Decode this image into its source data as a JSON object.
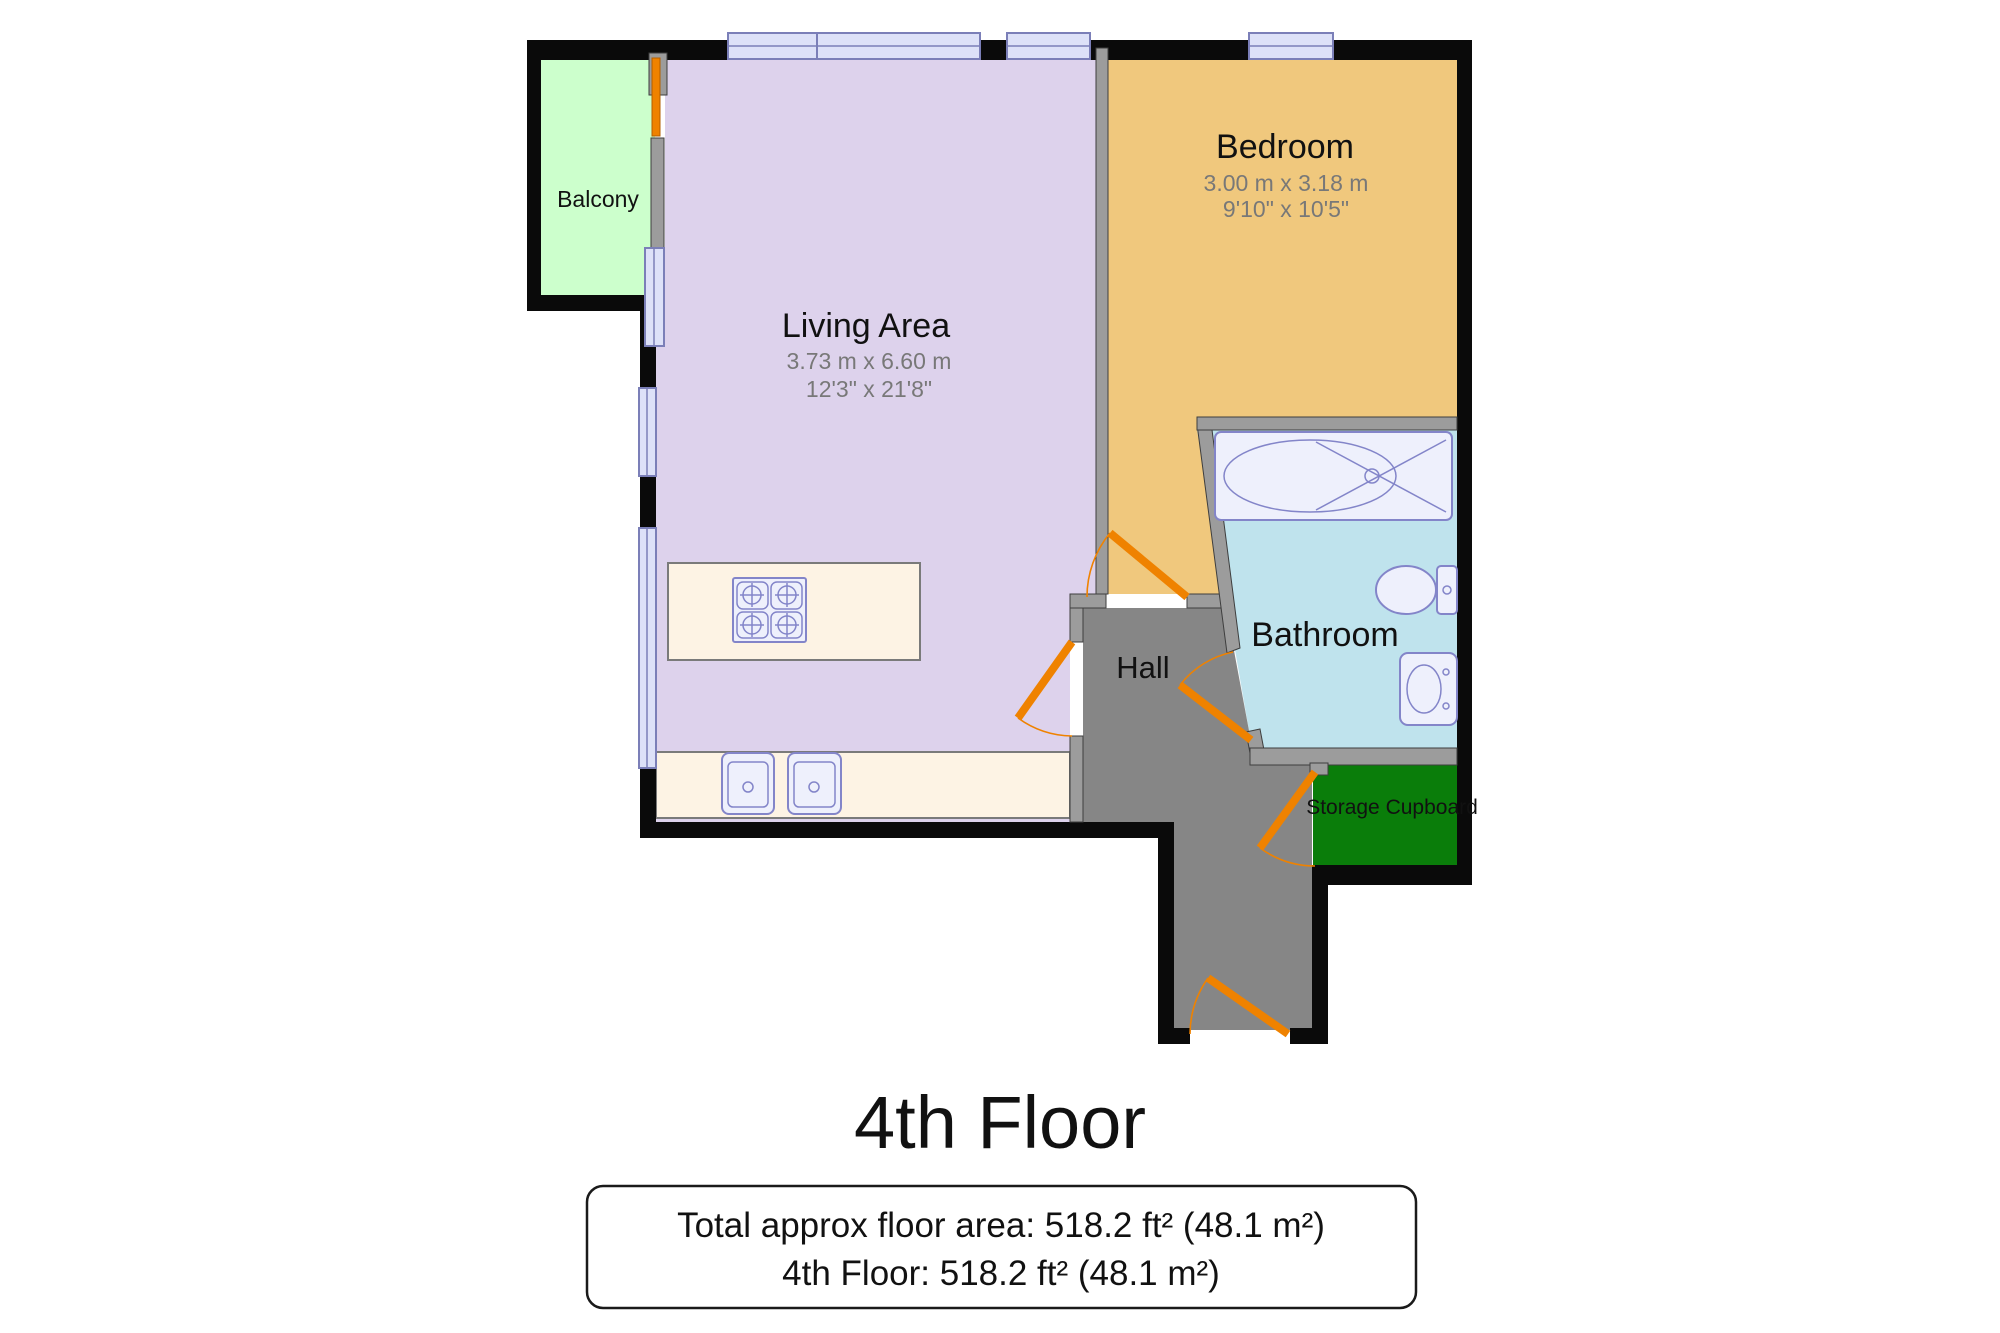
{
  "title": "4th Floor",
  "footer": {
    "line1": "Total approx floor area: 518.2 ft² (48.1 m²)",
    "line2": "4th Floor: 518.2 ft² (48.1 m²)"
  },
  "rooms": {
    "balcony": {
      "name": "Balcony",
      "color": "#ccffcc"
    },
    "living": {
      "name": "Living Area",
      "dim_metric": "3.73 m x 6.60 m",
      "dim_imperial": "12'3\" x 21'8\"",
      "color": "#ddd2ec"
    },
    "bedroom": {
      "name": "Bedroom",
      "dim_metric": "3.00 m x 3.18 m",
      "dim_imperial": "9'10\" x 10'5\"",
      "color": "#f0c87d"
    },
    "bathroom": {
      "name": "Bathroom",
      "color": "#bfe3ed"
    },
    "hall": {
      "name": "Hall",
      "color": "#868686"
    },
    "storage": {
      "name": "Storage Cupboard",
      "color": "#0a7d0a"
    }
  },
  "palette": {
    "wall": "#0a0a0a",
    "partition": "#9c9c9c",
    "door": "#ef8200",
    "window_fill": "#dde1f8",
    "window_stroke": "#7b7fb8",
    "fixture_fill": "#eef0fc",
    "fixture_stroke": "#8385c9",
    "counter": "#fdf3e4",
    "dim_text": "#787878"
  }
}
